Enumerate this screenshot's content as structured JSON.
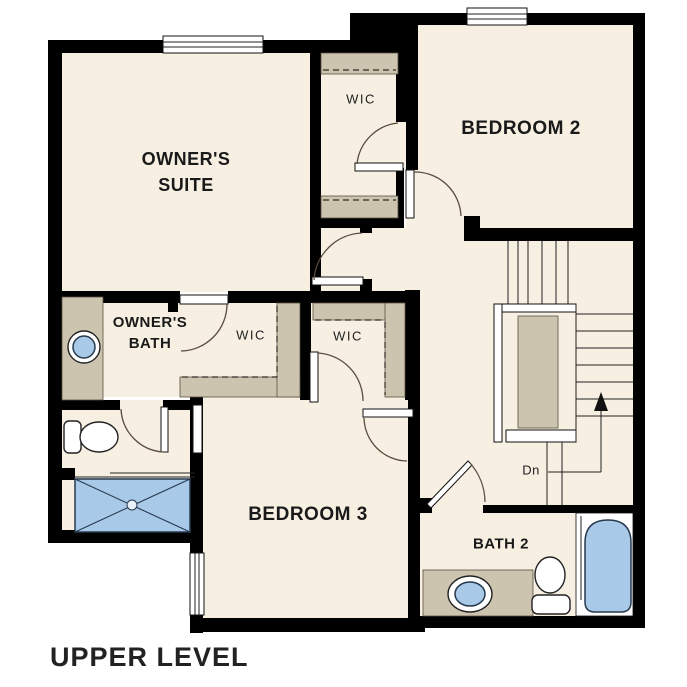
{
  "title": "UPPER LEVEL",
  "labels": {
    "owners_suite_line1": "OWNER'S",
    "owners_suite_line2": "SUITE",
    "wic_top": "WIC",
    "bedroom2": "BEDROOM 2",
    "owners_bath_line1": "OWNER'S",
    "owners_bath_line2": "BATH",
    "wic_middle": "WIC",
    "wic_right": "WIC",
    "bedroom3": "BEDROOM 3",
    "bath2": "BATH 2",
    "stairs_down": "Dn"
  },
  "colors": {
    "floor": "#f6efe2",
    "wall": "#000000",
    "casework": "#cdc4b0",
    "fixture_blue": "#a9c9e9",
    "outline": "#26394e",
    "label_text": "#1a1a1a"
  }
}
